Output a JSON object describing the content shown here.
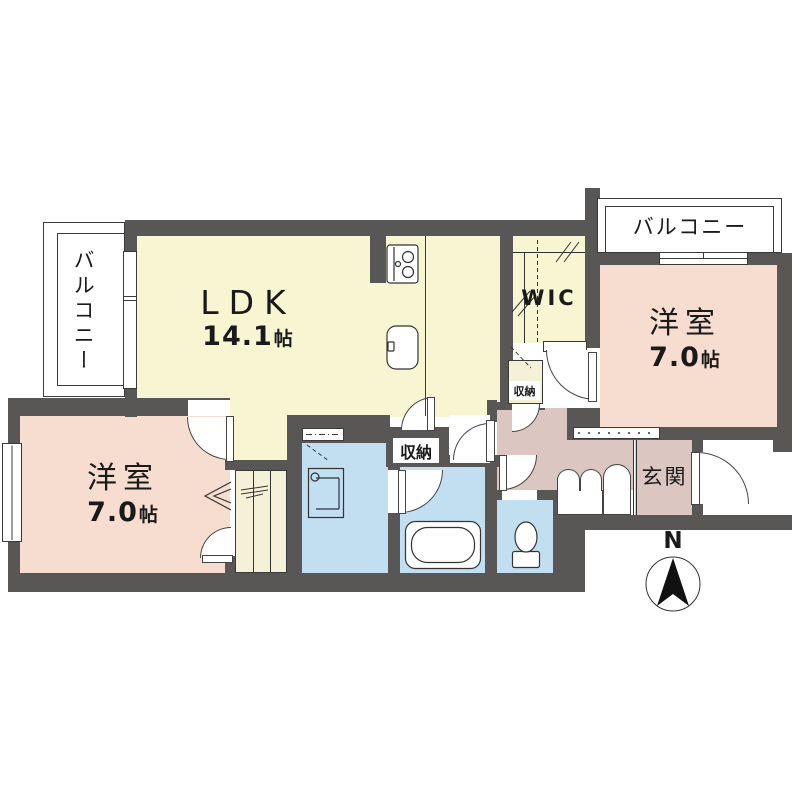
{
  "colors": {
    "wall": "#595656",
    "ldk": "#f8f6d2",
    "pink": "#f6ddd0",
    "hall": "#dcc6c1",
    "wet": "#c2def1",
    "closet": "#f5f1d9",
    "line": "#2b2b2b"
  },
  "rooms": {
    "balcony_left": {
      "label": "バルコニー"
    },
    "balcony_right": {
      "label": "バルコニー"
    },
    "ldk": {
      "name": "LDK",
      "area_value": "14.1",
      "area_unit": "帖"
    },
    "bedroom_left": {
      "name": "洋室",
      "area_value": "7.0",
      "area_unit": "帖"
    },
    "bedroom_right": {
      "name": "洋室",
      "area_value": "7.0",
      "area_unit": "帖"
    },
    "wic": {
      "label": "WIC"
    },
    "genkan": {
      "label": "玄関"
    },
    "storage_center": {
      "label": "収納"
    },
    "storage_hall": {
      "label": "収納"
    }
  },
  "compass": {
    "label": "N"
  }
}
